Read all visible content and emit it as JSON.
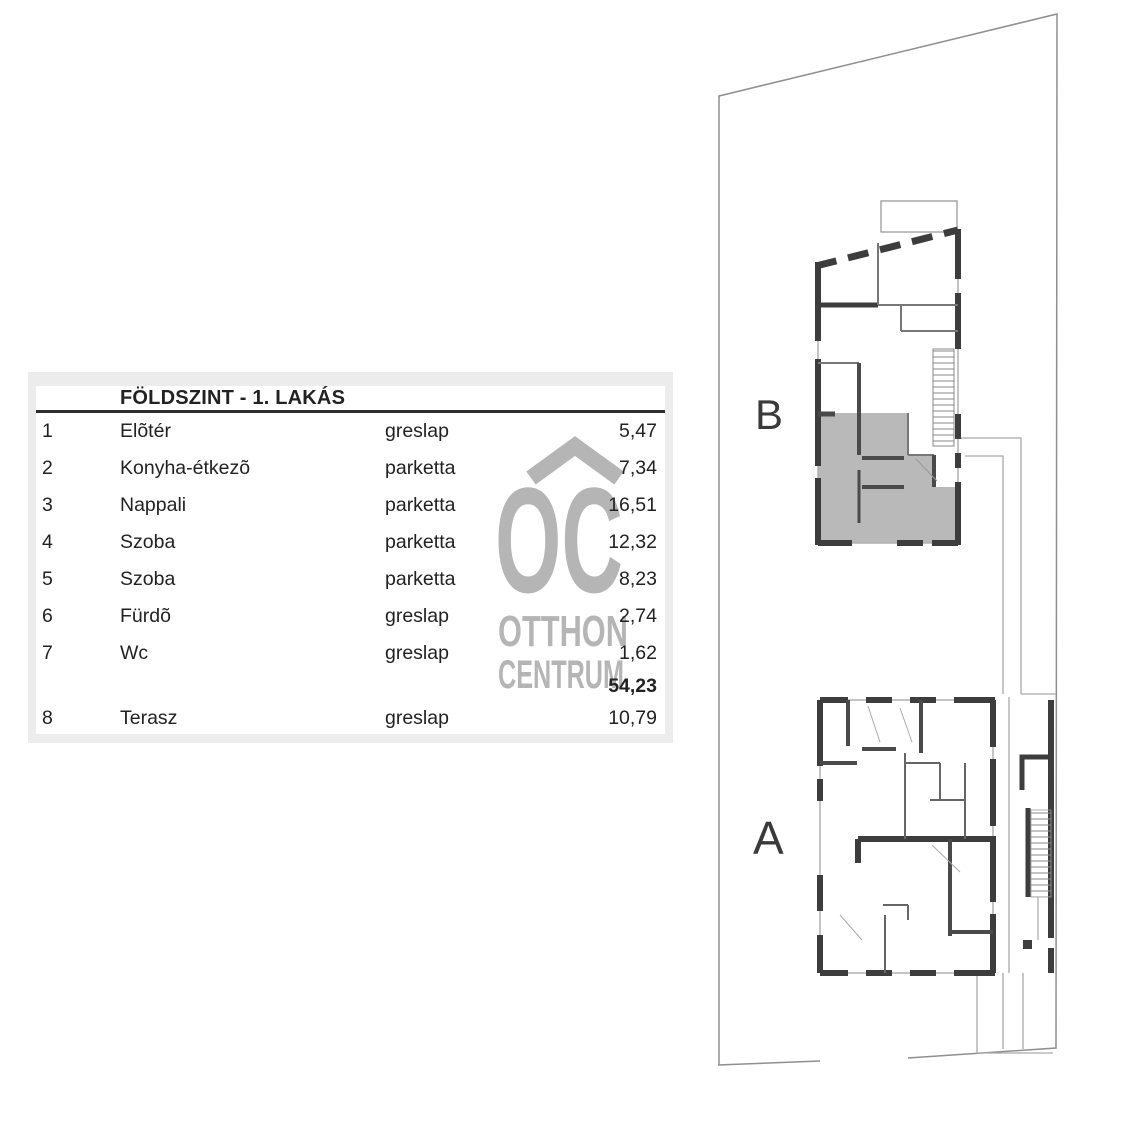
{
  "table": {
    "title": "FÖLDSZINT - 1. LAKÁS",
    "rows": [
      {
        "num": "1",
        "name": "Elõtér",
        "surface": "greslap",
        "area": "5,47"
      },
      {
        "num": "2",
        "name": "Konyha-étkezõ",
        "surface": "parketta",
        "area": "7,34"
      },
      {
        "num": "3",
        "name": "Nappali",
        "surface": "parketta",
        "area": "16,51"
      },
      {
        "num": "4",
        "name": "Szoba",
        "surface": "parketta",
        "area": "12,32"
      },
      {
        "num": "5",
        "name": "Szoba",
        "surface": "parketta",
        "area": "8,23"
      },
      {
        "num": "6",
        "name": "Fürdõ",
        "surface": "greslap",
        "area": "2,74"
      },
      {
        "num": "7",
        "name": "Wc",
        "surface": "greslap",
        "area": "1,62"
      }
    ],
    "total_area": "54,23",
    "terrace_row": {
      "num": "8",
      "name": "Terasz",
      "surface": "greslap",
      "area": "10,79"
    }
  },
  "watermark": {
    "initials": "OC",
    "line1": "OTTHON",
    "line2": "CENTRUM",
    "chevron_icon": "roof-chevron-icon",
    "color": "#b5b5b5"
  },
  "plan": {
    "building_b_label": "B",
    "building_a_label": "A",
    "highlighted_unit": "ground floor apartment 1 (gray fill, building B)",
    "colors": {
      "wall": "#3d3d3d",
      "unit_highlight": "#b9b9b9",
      "site_boundary": "#8f8f8f",
      "thin_line": "#9a9a9a",
      "table_frame": "#ececec"
    }
  }
}
